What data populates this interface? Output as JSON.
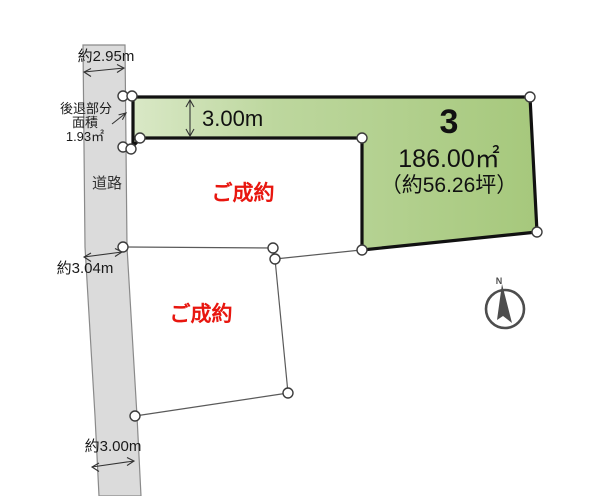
{
  "diagram_type": "real-estate-lot-plan",
  "road": {
    "label": "道路",
    "top_width_label": "約2.95m",
    "mid_width_label": "約3.04m",
    "bottom_width_label": "約3.00m"
  },
  "setback_note": {
    "line1": "後退部分",
    "line2": "面積",
    "line3": "1.93㎡"
  },
  "lot3": {
    "number": "3",
    "area_sqm": "186.00㎡",
    "area_tsubo": "（約56.26坪）",
    "strip_depth_label": "3.00m"
  },
  "sold_lots": [
    {
      "status": "ご成約"
    },
    {
      "status": "ご成約"
    }
  ],
  "compass": {
    "north_label": "N"
  },
  "colors": {
    "lot_fill_light": "#d9e8c6",
    "lot_fill_dark": "#a6c87c",
    "lot_border": "#111111",
    "road_fill": "#dbdbdb",
    "road_border": "#8a8a8a",
    "boundary_line": "#5a5a5a",
    "sold_text": "#e8160f",
    "dimension_text": "#1a1a1a",
    "compass": "#4d4d4d"
  }
}
